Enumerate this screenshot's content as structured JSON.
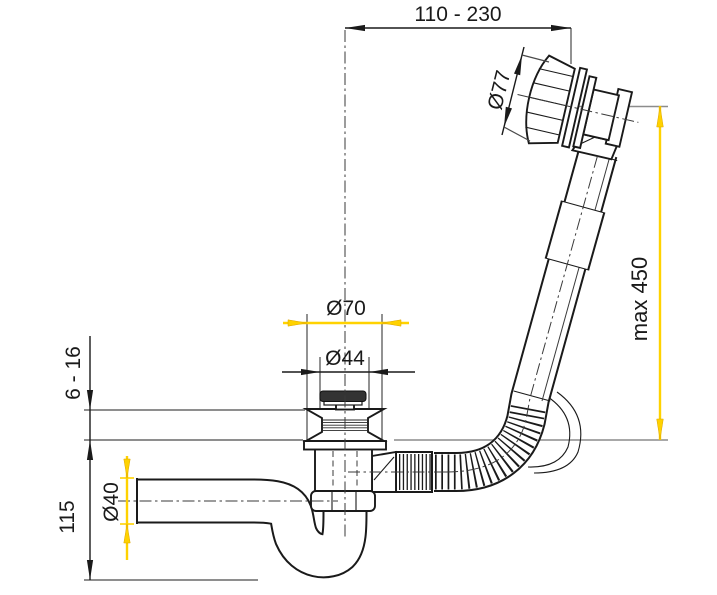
{
  "drawing": {
    "type": "technical-dimension-drawing",
    "subject": "bath-waste-siphon-with-flexible-overflow",
    "dimensions": {
      "horizontal_reach": {
        "label": "110 - 230",
        "orientation": "horizontal"
      },
      "knob_diameter": {
        "label": "Ø77",
        "orientation": "diagonal"
      },
      "max_height": {
        "label": "max 450",
        "orientation": "vertical"
      },
      "flange_diameter": {
        "label": "Ø70",
        "orientation": "horizontal"
      },
      "plug_diameter": {
        "label": "Ø44",
        "orientation": "horizontal"
      },
      "rim_thickness": {
        "label": "6 - 16",
        "orientation": "vertical"
      },
      "trap_height": {
        "label": "115",
        "orientation": "vertical"
      },
      "outlet_diameter": {
        "label": "Ø40",
        "orientation": "vertical"
      }
    },
    "colors": {
      "dimension_accent": "#ffd200",
      "reference_line": "#8c8c8c",
      "linework": "#1a1a1a",
      "background": "#ffffff",
      "plug_cap": "#333333"
    }
  }
}
